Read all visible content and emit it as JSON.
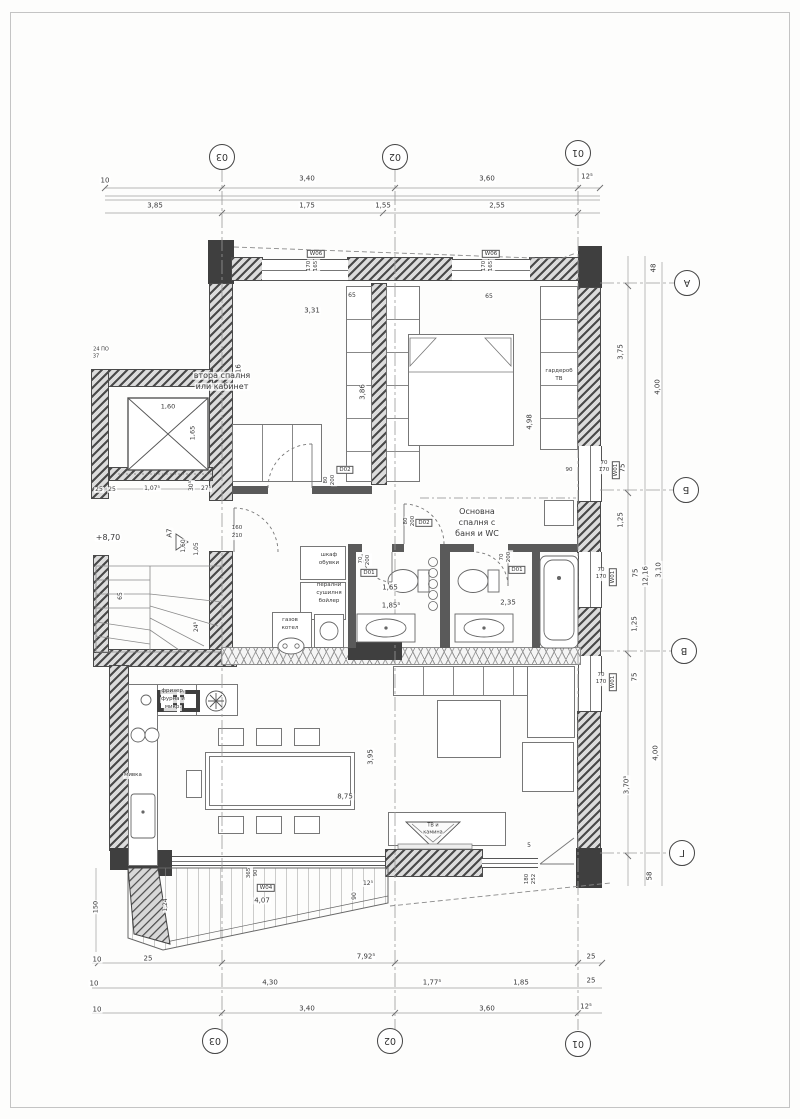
{
  "drawing": {
    "type": "apartment-floor-plan",
    "language": "bulgarian",
    "level_note": "+8,70",
    "section_mark": "А7"
  },
  "bubbles": [
    {
      "t": "03",
      "x": 222,
      "y": 157,
      "n": "grid-bubble-03-top"
    },
    {
      "t": "02",
      "x": 395,
      "y": 157,
      "n": "grid-bubble-02-top"
    },
    {
      "t": "01",
      "x": 578,
      "y": 153,
      "n": "grid-bubble-01-top"
    },
    {
      "t": "03",
      "x": 215,
      "y": 1041,
      "n": "grid-bubble-03-bottom"
    },
    {
      "t": "02",
      "x": 390,
      "y": 1041,
      "n": "grid-bubble-02-bottom"
    },
    {
      "t": "01",
      "x": 578,
      "y": 1044,
      "n": "grid-bubble-01-bottom"
    },
    {
      "t": "А",
      "x": 687,
      "y": 283,
      "n": "grid-bubble-A"
    },
    {
      "t": "Б",
      "x": 686,
      "y": 490,
      "n": "grid-bubble-B"
    },
    {
      "t": "В",
      "x": 684,
      "y": 651,
      "n": "grid-bubble-V"
    },
    {
      "t": "Г",
      "x": 682,
      "y": 853,
      "n": "grid-bubble-G"
    }
  ],
  "tags": [
    {
      "t": "W06",
      "x": 316,
      "y": 254
    },
    {
      "t": "W06",
      "x": 491,
      "y": 254
    },
    {
      "t": "W01",
      "x": 616,
      "y": 470,
      "r": -90
    },
    {
      "t": "W01",
      "x": 613,
      "y": 577,
      "r": -90
    },
    {
      "t": "W01",
      "x": 613,
      "y": 682,
      "r": -90
    },
    {
      "t": "D02",
      "x": 345,
      "y": 470
    },
    {
      "t": "D02",
      "x": 424,
      "y": 523
    },
    {
      "t": "D01",
      "x": 369,
      "y": 573
    },
    {
      "t": "D01",
      "x": 517,
      "y": 570
    },
    {
      "t": "W04",
      "x": 266,
      "y": 888
    }
  ],
  "labels": [
    {
      "t": "10",
      "x": 105,
      "y": 181
    },
    {
      "t": "3,40",
      "x": 307,
      "y": 179
    },
    {
      "t": "3,60",
      "x": 487,
      "y": 179
    },
    {
      "t": "12⁵",
      "x": 587,
      "y": 177
    },
    {
      "t": "3,85",
      "x": 155,
      "y": 206
    },
    {
      "t": "1,75",
      "x": 307,
      "y": 206
    },
    {
      "t": "1,55",
      "x": 383,
      "y": 206
    },
    {
      "t": "2,55",
      "x": 497,
      "y": 206
    },
    {
      "t": "170",
      "x": 310,
      "y": 266,
      "r": -90,
      "s": 5.5
    },
    {
      "t": "165",
      "x": 317,
      "y": 266,
      "r": -90,
      "s": 5.5
    },
    {
      "t": "170",
      "x": 485,
      "y": 266,
      "r": -90,
      "s": 5.5
    },
    {
      "t": "165",
      "x": 492,
      "y": 266,
      "r": -90,
      "s": 5.5
    },
    {
      "t": "65",
      "x": 352,
      "y": 296,
      "s": 6
    },
    {
      "t": "65",
      "x": 489,
      "y": 297,
      "s": 6
    },
    {
      "t": "3,31",
      "x": 312,
      "y": 311
    },
    {
      "t": "3,16",
      "x": 239,
      "y": 372,
      "r": -90
    },
    {
      "t": "3,86",
      "x": 363,
      "y": 392,
      "r": -90
    },
    {
      "t": "4,98",
      "x": 530,
      "y": 422,
      "r": -90
    },
    {
      "t": "90",
      "x": 569,
      "y": 471,
      "s": 5.5
    },
    {
      "t": "1,60",
      "x": 168,
      "y": 407,
      "s": 6.5
    },
    {
      "t": "1,65",
      "x": 193,
      "y": 433,
      "r": -90,
      "s": 6.5
    },
    {
      "t": "24 ПО",
      "x": 101,
      "y": 350,
      "s": 5,
      "n": "tiny-note"
    },
    {
      "t": "37",
      "x": 96,
      "y": 357,
      "s": 5,
      "n": "tiny-note"
    },
    {
      "t": "25",
      "x": 99,
      "y": 490,
      "s": 6
    },
    {
      "t": "25",
      "x": 112,
      "y": 490,
      "s": 6
    },
    {
      "t": "1,07⁵",
      "x": 152,
      "y": 489,
      "s": 6
    },
    {
      "t": "30⁵",
      "x": 192,
      "y": 486,
      "r": -90,
      "s": 6
    },
    {
      "t": "27⁵",
      "x": 206,
      "y": 489,
      "s": 6
    },
    {
      "t": "+8,70",
      "x": 108,
      "y": 538,
      "s": 8,
      "n": "level-marker"
    },
    {
      "t": "А7",
      "x": 170,
      "y": 533,
      "r": -90,
      "s": 7,
      "n": "section-marker"
    },
    {
      "t": "1,60",
      "x": 184,
      "y": 546,
      "r": -90,
      "s": 6
    },
    {
      "t": "1,05",
      "x": 197,
      "y": 549,
      "r": -90,
      "s": 6
    },
    {
      "t": "65",
      "x": 121,
      "y": 596,
      "r": -90,
      "s": 6
    },
    {
      "t": "24⁵",
      "x": 197,
      "y": 627,
      "r": -90,
      "s": 6
    },
    {
      "t": "160",
      "x": 237,
      "y": 529,
      "s": 5.5
    },
    {
      "t": "210",
      "x": 237,
      "y": 537,
      "s": 5.5
    },
    {
      "t": "80",
      "x": 327,
      "y": 480,
      "r": -90,
      "s": 5.5
    },
    {
      "t": "200",
      "x": 334,
      "y": 480,
      "r": -90,
      "s": 5.5
    },
    {
      "t": "80",
      "x": 407,
      "y": 521,
      "r": -90,
      "s": 5.5
    },
    {
      "t": "200",
      "x": 414,
      "y": 521,
      "r": -90,
      "s": 5.5
    },
    {
      "t": "70",
      "x": 362,
      "y": 560,
      "r": -90,
      "s": 5.5
    },
    {
      "t": "200",
      "x": 369,
      "y": 560,
      "r": -90,
      "s": 5.5
    },
    {
      "t": "70",
      "x": 503,
      "y": 557,
      "r": -90,
      "s": 5.5
    },
    {
      "t": "200",
      "x": 510,
      "y": 557,
      "r": -90,
      "s": 5.5
    },
    {
      "t": "70",
      "x": 604,
      "y": 464,
      "s": 5.5
    },
    {
      "t": "170",
      "x": 604,
      "y": 471,
      "s": 5.5
    },
    {
      "t": "70",
      "x": 601,
      "y": 571,
      "s": 5.5
    },
    {
      "t": "170",
      "x": 601,
      "y": 578,
      "s": 5.5
    },
    {
      "t": "70",
      "x": 601,
      "y": 676,
      "s": 5.5
    },
    {
      "t": "170",
      "x": 601,
      "y": 683,
      "s": 5.5
    },
    {
      "t": "365",
      "x": 250,
      "y": 873,
      "r": -90,
      "s": 5.5
    },
    {
      "t": "90",
      "x": 257,
      "y": 873,
      "r": -90,
      "s": 5.5
    },
    {
      "t": "180",
      "x": 528,
      "y": 879,
      "r": -90,
      "s": 5.5
    },
    {
      "t": "252",
      "x": 535,
      "y": 879,
      "r": -90,
      "s": 5.5
    },
    {
      "t": "1,65",
      "x": 390,
      "y": 588
    },
    {
      "t": "1,85⁵",
      "x": 391,
      "y": 606
    },
    {
      "t": "2,35",
      "x": 508,
      "y": 603
    },
    {
      "t": "3,95",
      "x": 371,
      "y": 757,
      "r": -90
    },
    {
      "t": "8,75",
      "x": 345,
      "y": 797
    },
    {
      "t": "5",
      "x": 529,
      "y": 846,
      "s": 6
    },
    {
      "t": "150",
      "x": 96,
      "y": 907,
      "r": -90,
      "s": 6.5
    },
    {
      "t": "1,24",
      "x": 166,
      "y": 905,
      "r": -90,
      "s": 6
    },
    {
      "t": "90",
      "x": 355,
      "y": 896,
      "r": -90,
      "s": 6
    },
    {
      "t": "12⁵",
      "x": 368,
      "y": 884,
      "s": 6
    },
    {
      "t": "4,07",
      "x": 262,
      "y": 901
    },
    {
      "t": "10",
      "x": 97,
      "y": 960
    },
    {
      "t": "25",
      "x": 148,
      "y": 959
    },
    {
      "t": "7,92⁵",
      "x": 366,
      "y": 957
    },
    {
      "t": "25",
      "x": 591,
      "y": 957
    },
    {
      "t": "10",
      "x": 94,
      "y": 984
    },
    {
      "t": "4,30",
      "x": 270,
      "y": 983
    },
    {
      "t": "1,77⁵",
      "x": 432,
      "y": 983
    },
    {
      "t": "1,85",
      "x": 521,
      "y": 983
    },
    {
      "t": "25",
      "x": 591,
      "y": 981
    },
    {
      "t": "10",
      "x": 97,
      "y": 1010
    },
    {
      "t": "3,40",
      "x": 307,
      "y": 1009
    },
    {
      "t": "3,60",
      "x": 487,
      "y": 1009
    },
    {
      "t": "12⁵",
      "x": 586,
      "y": 1007
    },
    {
      "t": "48",
      "x": 654,
      "y": 268,
      "r": -90
    },
    {
      "t": "3,75",
      "x": 621,
      "y": 352,
      "r": -90
    },
    {
      "t": "4,00",
      "x": 658,
      "y": 387,
      "r": -90
    },
    {
      "t": "75",
      "x": 623,
      "y": 468,
      "r": -90
    },
    {
      "t": "1,25",
      "x": 621,
      "y": 520,
      "r": -90
    },
    {
      "t": "75",
      "x": 636,
      "y": 573,
      "r": -90
    },
    {
      "t": "12,16",
      "x": 646,
      "y": 576,
      "r": -90
    },
    {
      "t": "3,10",
      "x": 659,
      "y": 570,
      "r": -90
    },
    {
      "t": "1,25",
      "x": 635,
      "y": 624,
      "r": -90
    },
    {
      "t": "75",
      "x": 635,
      "y": 677,
      "r": -90
    },
    {
      "t": "4,00",
      "x": 656,
      "y": 753,
      "r": -90
    },
    {
      "t": "3,70⁵",
      "x": 627,
      "y": 785,
      "r": -90
    },
    {
      "t": "58",
      "x": 650,
      "y": 876,
      "r": -90
    },
    {
      "t": "втора спалня",
      "x": 222,
      "y": 376,
      "s": 8,
      "n": "room-second-bedroom"
    },
    {
      "t": "или кабинет",
      "x": 222,
      "y": 387,
      "s": 8,
      "n": "room-second-bedroom"
    },
    {
      "t": "Основна",
      "x": 477,
      "y": 512,
      "s": 8,
      "n": "room-master-bedroom"
    },
    {
      "t": "спалня с",
      "x": 477,
      "y": 523,
      "s": 8,
      "n": "room-master-bedroom"
    },
    {
      "t": "баня и WC",
      "x": 477,
      "y": 534,
      "s": 8,
      "n": "room-master-bedroom"
    },
    {
      "t": "гардероб",
      "x": 559,
      "y": 372,
      "s": 5.5,
      "n": "wardrobe-label"
    },
    {
      "t": "ТВ",
      "x": 559,
      "y": 380,
      "s": 5.5,
      "n": "wardrobe-label"
    },
    {
      "t": "шкаф",
      "x": 329,
      "y": 556,
      "s": 5.5,
      "n": "shoe-cabinet-label"
    },
    {
      "t": "обувки",
      "x": 329,
      "y": 564,
      "s": 5.5,
      "n": "shoe-cabinet-label"
    },
    {
      "t": "перални",
      "x": 329,
      "y": 586,
      "s": 5.5,
      "n": "laundry-label"
    },
    {
      "t": "сушилня",
      "x": 329,
      "y": 594,
      "s": 5.5,
      "n": "laundry-label"
    },
    {
      "t": "бойлер",
      "x": 329,
      "y": 602,
      "s": 5.5,
      "n": "laundry-label"
    },
    {
      "t": "газов",
      "x": 290,
      "y": 621,
      "s": 5.5,
      "n": "gas-boiler-label"
    },
    {
      "t": "котел",
      "x": 290,
      "y": 629,
      "s": 5.5,
      "n": "gas-boiler-label"
    },
    {
      "t": "фризер,",
      "x": 173,
      "y": 692,
      "s": 5.5,
      "n": "kitchen-appliances-label"
    },
    {
      "t": "фурна и",
      "x": 173,
      "y": 700,
      "s": 5.5,
      "n": "kitchen-appliances-label"
    },
    {
      "t": "микр.",
      "x": 173,
      "y": 708,
      "s": 5.5,
      "n": "kitchen-appliances-label"
    },
    {
      "t": "мивка",
      "x": 133,
      "y": 776,
      "s": 5.5,
      "n": "sink-label"
    },
    {
      "t": "ТВ и",
      "x": 433,
      "y": 826,
      "s": 5,
      "n": "tv-fireplace-label"
    },
    {
      "t": "камина",
      "x": 433,
      "y": 833,
      "s": 5,
      "n": "tv-fireplace-label"
    }
  ]
}
